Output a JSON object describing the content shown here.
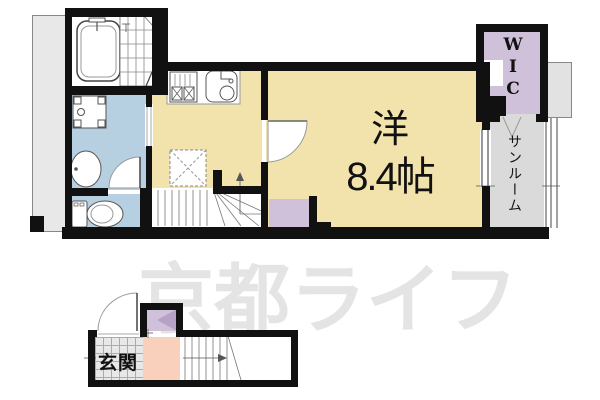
{
  "watermark": {
    "text": "京都ライフ"
  },
  "rooms": {
    "main": {
      "name": "洋",
      "size": "8.4帖"
    },
    "wic": {
      "letters": [
        "W",
        "I",
        "C"
      ]
    },
    "sunroom": {
      "label": "サンルーム"
    },
    "entrance": {
      "label": "玄関"
    }
  },
  "colors": {
    "room_tan": "#f2e2ac",
    "wet_area_blue": "#b7d0e1",
    "closet_purple": "#cfc1d9",
    "closet_dark_purple": "#b5a2c5",
    "hall_pink": "#f8d0bb",
    "sunroom_gray": "#dadada",
    "balcony_gray": "#e8e8e8",
    "wall": "#111111",
    "watermark_gray": "#e4e4e4"
  }
}
